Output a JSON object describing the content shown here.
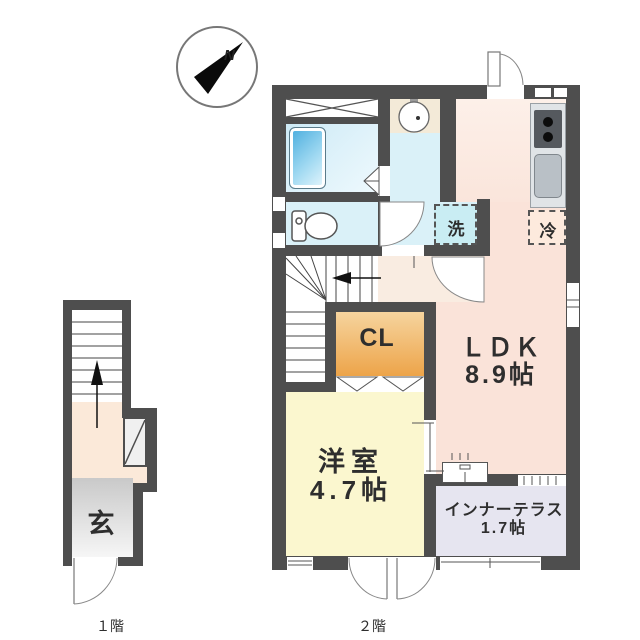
{
  "compass": {
    "north": "N"
  },
  "floor2": {
    "label": "２階",
    "ldk_name": "ＬＤＫ",
    "ldk_size": "8.9帖",
    "western_name": "洋室",
    "western_size": "4.7帖",
    "closet": "CL",
    "terrace_name": "インナーテラス",
    "terrace_size": "1.7帖",
    "washer": "洗",
    "fridge": "冷"
  },
  "floor1": {
    "label": "１階",
    "entrance": "玄"
  },
  "colors": {
    "wall": "#4e4e4e",
    "ldk_floor": "#fae3d9",
    "western_floor": "#fbf7cf",
    "terrace_floor": "#e6e5f0",
    "wet_area_floor": "#daf1f8",
    "closet_top": "#f6d49e",
    "closet_bottom": "#eda449",
    "hall_floor": "#f9ece1",
    "bathtub_blue": "#47abdd",
    "washer_box": "#c9edf3",
    "fridge_box": "#fdeadd",
    "genkan_gray": "#cccccc"
  }
}
